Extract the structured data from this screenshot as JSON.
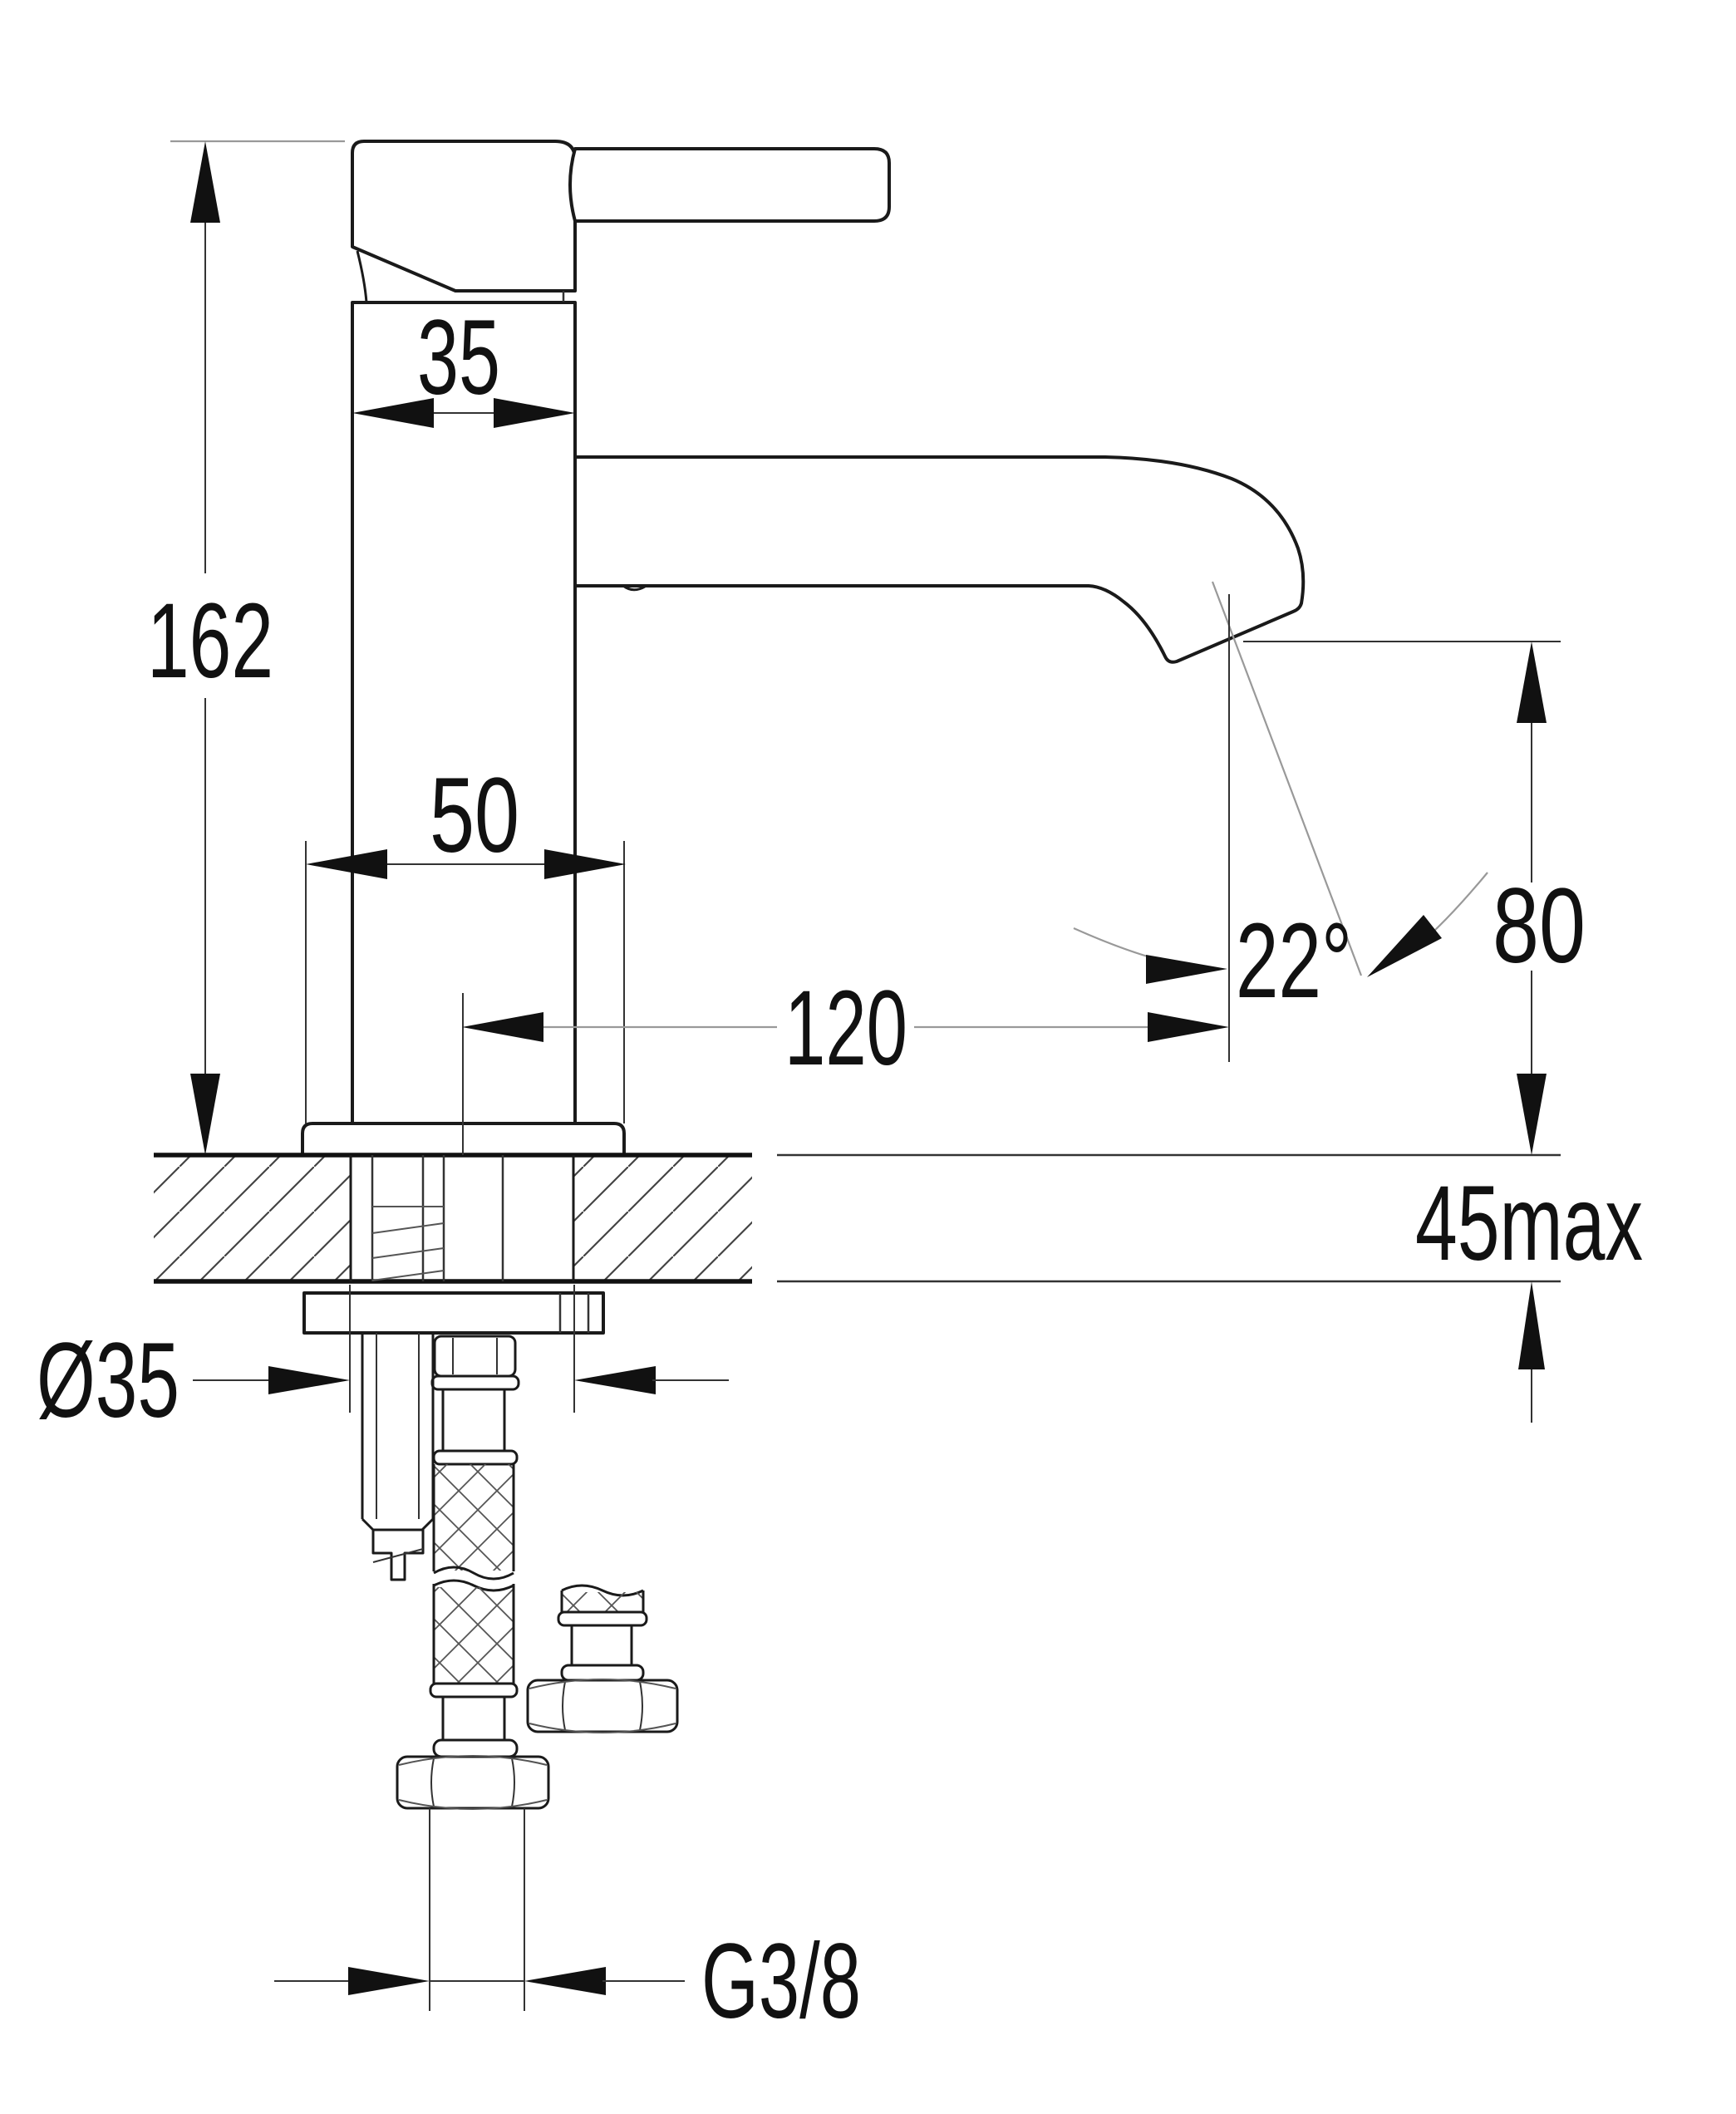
{
  "drawing": {
    "kind": "technical-dimension-drawing",
    "subject": "single-lever basin mixer tap, side section view with mounting hardware"
  },
  "dimensions": {
    "spout_body_width": "35",
    "overall_height": "162",
    "base_width": "50",
    "spout_reach": "120",
    "stream_angle": "22°",
    "outlet_height": "80",
    "deck_thickness_max": "45max",
    "hole_diameter": "Ø35",
    "thread_size": "G3/8"
  },
  "colors": {
    "background": "#ffffff",
    "outline": "#1a1a1a",
    "dimension": "#333333",
    "light_line": "#999999",
    "text": "#111111"
  }
}
